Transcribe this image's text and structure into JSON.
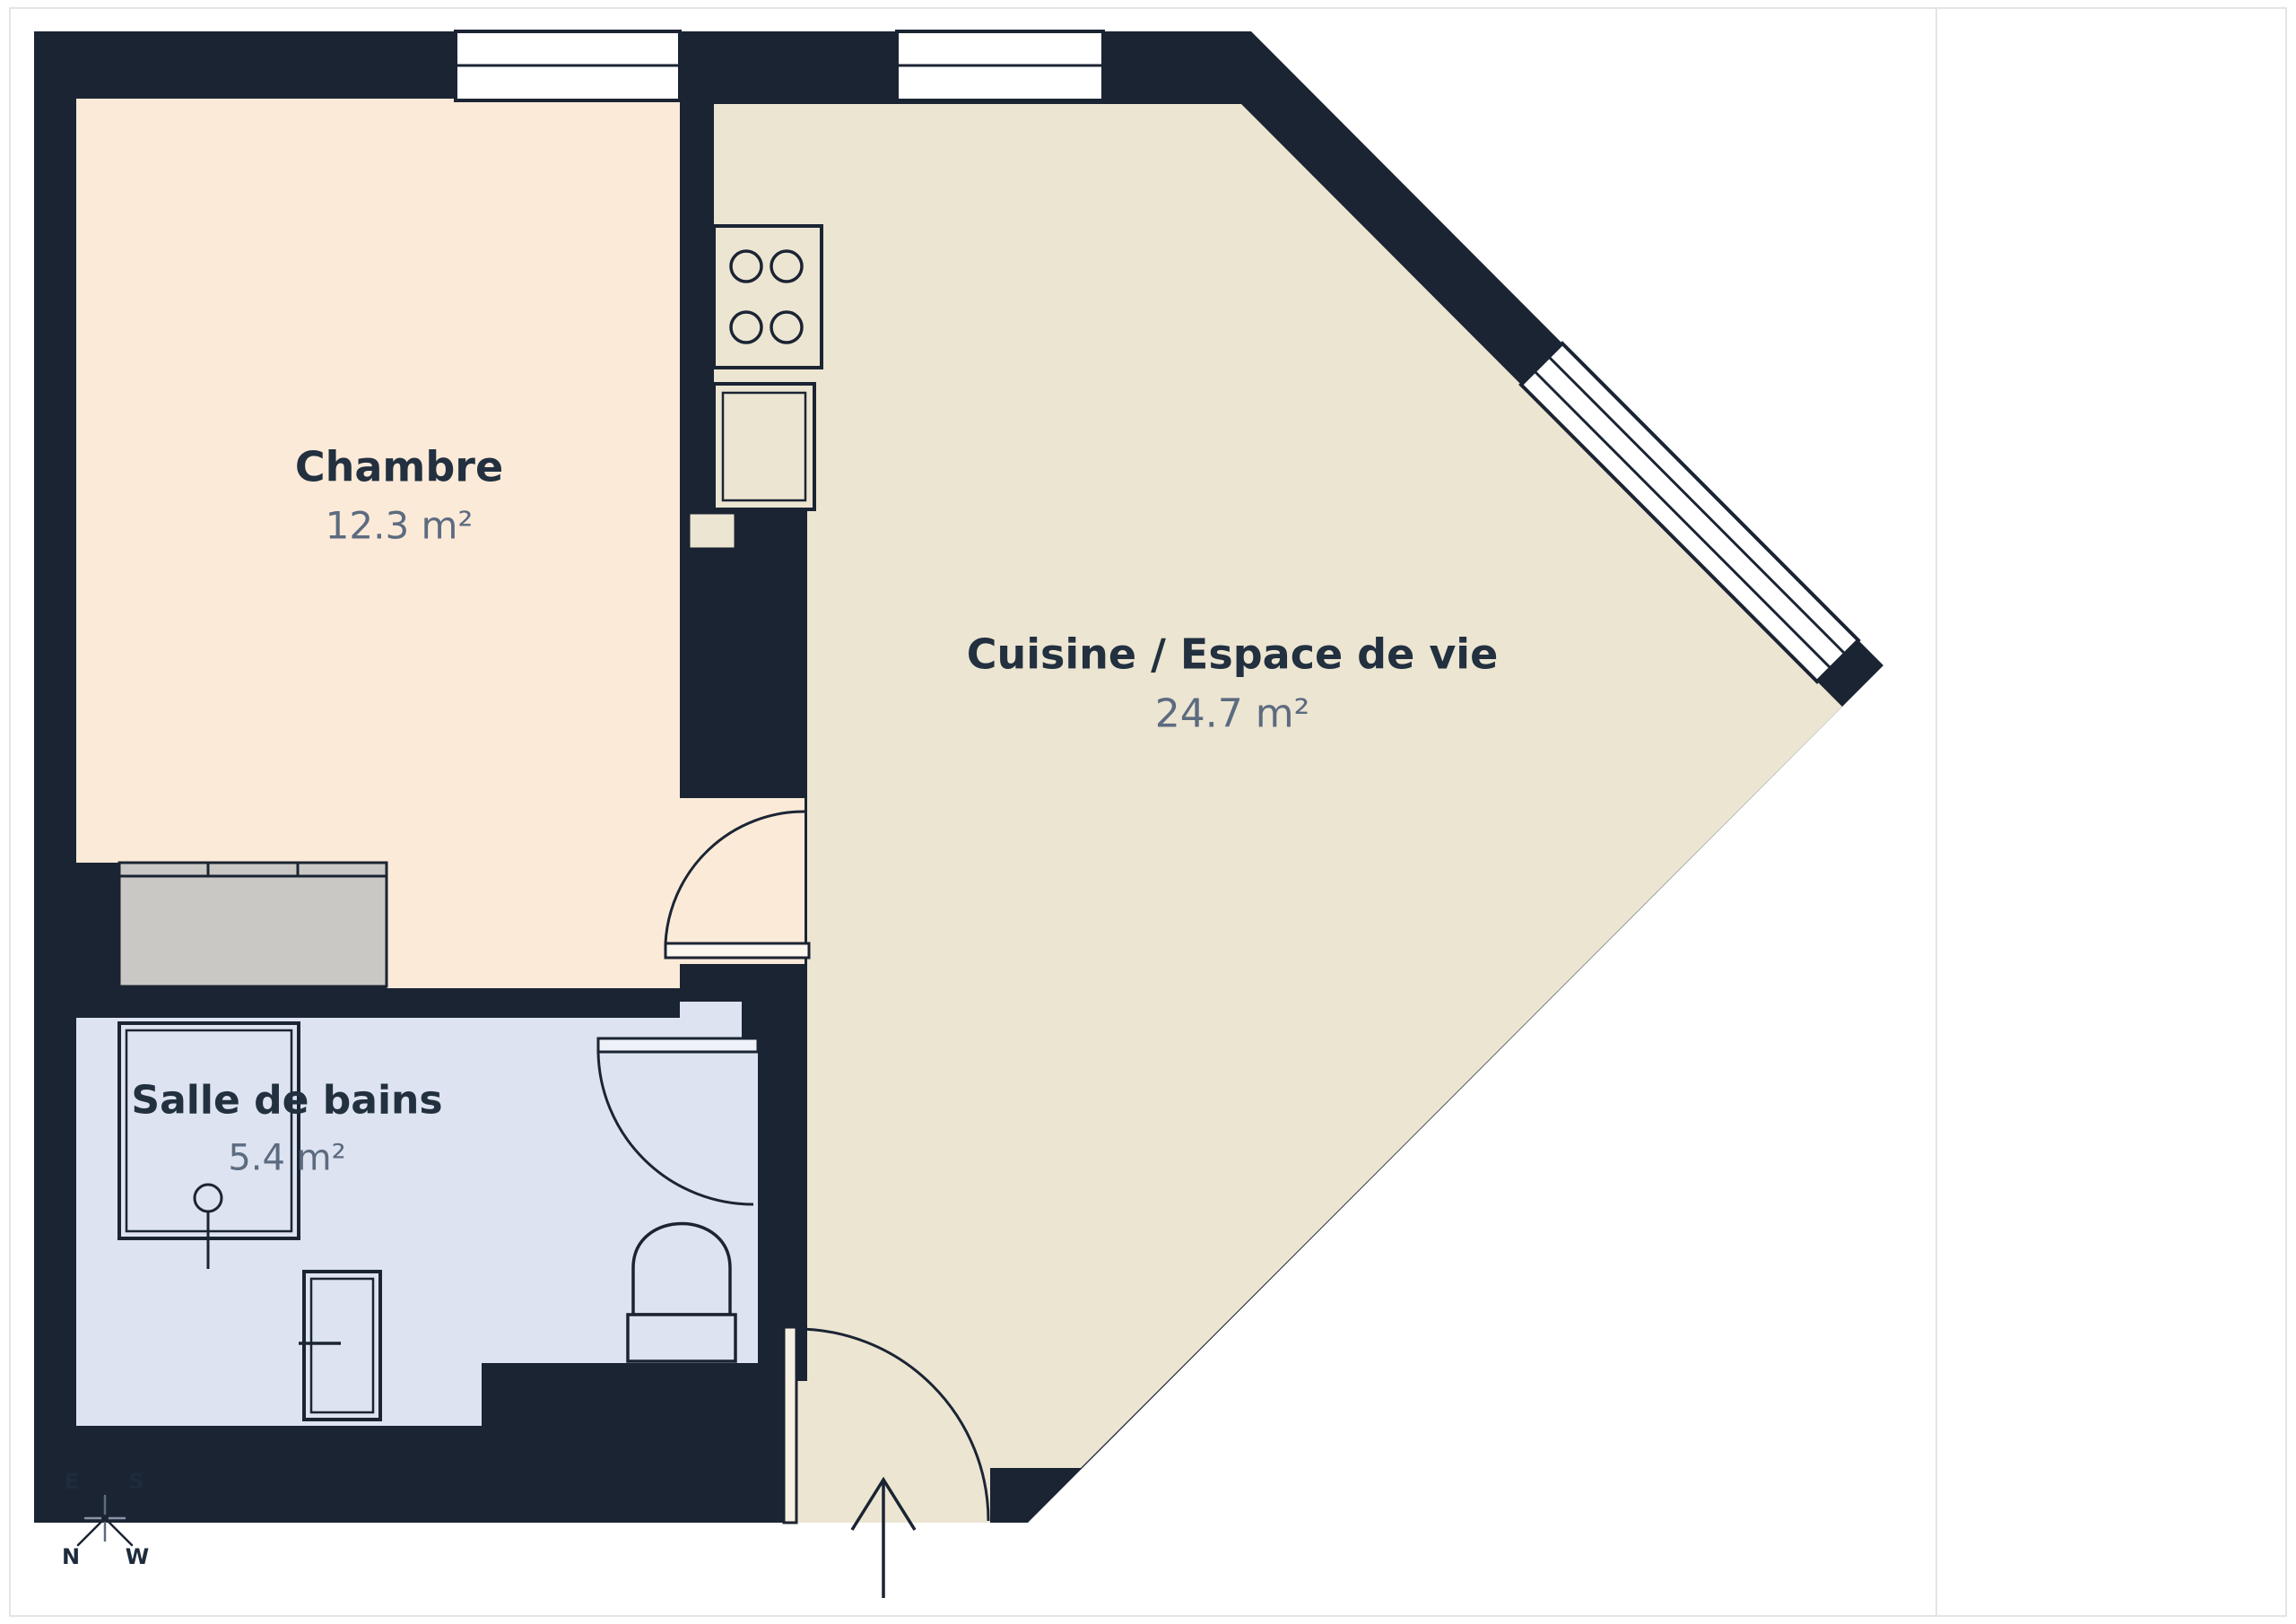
{
  "page": {
    "background": "#ffffff",
    "border_color": "#e3e4e7"
  },
  "plan": {
    "wall_color": "#1b2433",
    "rooms": [
      {
        "id": "chambre",
        "label": "Chambre",
        "area": "12.3 m²",
        "floor_color": "#fcead9"
      },
      {
        "id": "cuisine",
        "label": "Cuisine / Espace de vie",
        "area": "24.7 m²",
        "floor_color": "#ece5d2"
      },
      {
        "id": "salle-de-bains",
        "label": "Salle de bains",
        "area": "5.4 m²",
        "floor_color": "#dde3f0"
      }
    ],
    "closet_color": "#c9c8c5",
    "label_color": "#22303f",
    "area_color": "#5c6b7f"
  },
  "compass": {
    "top_left": "E",
    "top_right": "S",
    "bottom_left": "N",
    "bottom_right": "W"
  },
  "sidebar": {
    "title": "Surface totale approximative",
    "title_superscript": "(1)",
    "total_area": "43.2 m²",
    "footnote": "(1) Hors balcons et terrasses",
    "disclaimer": "Les calculs se réfèrent à la norme RICS IPMS 3C. Toutes les mesures sont approximatives et ne sont pas à l’échelle. Ce plan d’étage n’a qu’un but illustratif.",
    "brand_name": "GIRAFFE",
    "brand_suffix": "360"
  }
}
